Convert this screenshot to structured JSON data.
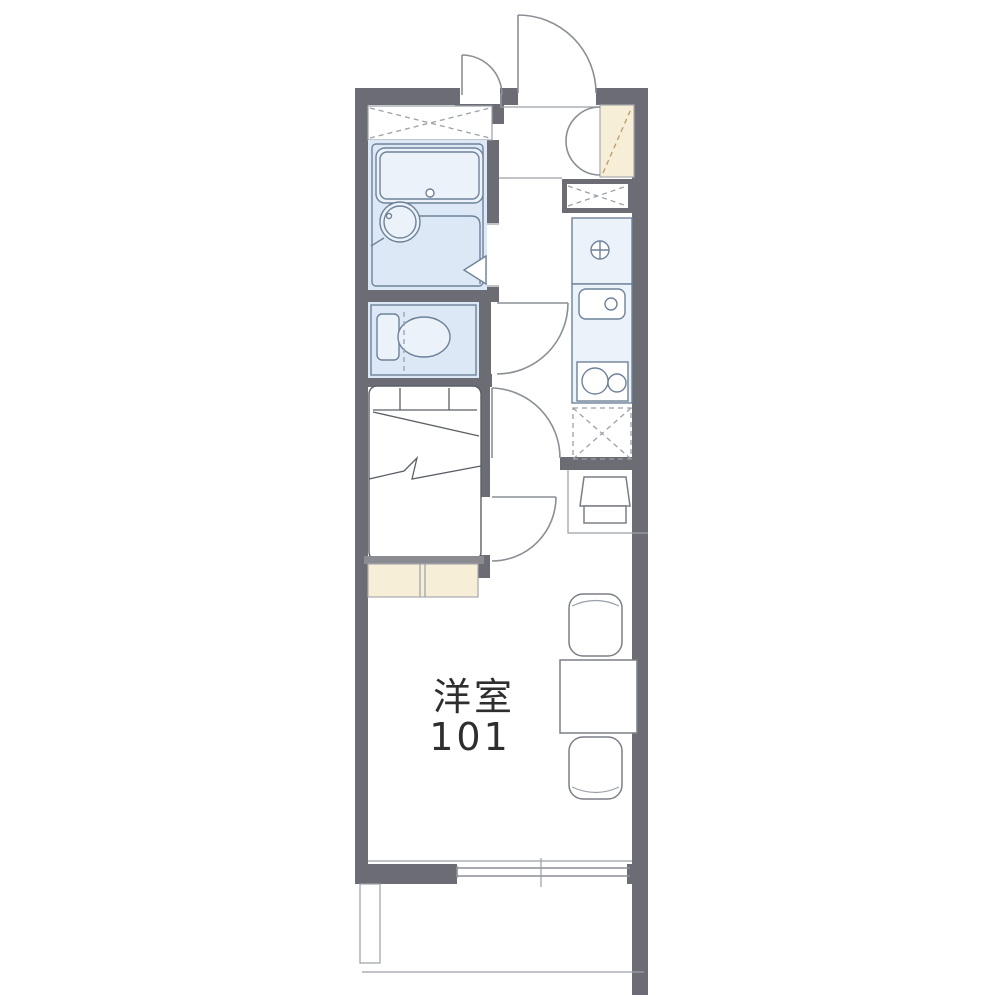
{
  "floorplan": {
    "room_label": {
      "line1": "洋室",
      "line2": "101"
    },
    "colors": {
      "background": "#ffffff",
      "wall": "#6c6c75",
      "water_area_fill": "#dce8f6",
      "water_area_stroke": "#6e8299",
      "storage_fill": "#f6eed6",
      "storage_dash": "#b79d6a",
      "line": "#9aa0a8",
      "furniture_stroke": "#7a7f85",
      "label_text": "#2e2e30"
    },
    "fixtures": [
      "entrance-door",
      "small-door",
      "shoe-cabinet",
      "shoe-cabinet-doors",
      "overhead-closet",
      "bathtub",
      "washbasin",
      "bathroom-folding-door",
      "toilet",
      "hall-door",
      "washing-machine-space",
      "washing-machine-pan",
      "kitchen-sink",
      "gas-stove",
      "refrigerator-space",
      "room-door",
      "bedroom-door",
      "bed",
      "under-bed-storage",
      "tv-stand",
      "table",
      "chair-top",
      "chair-bottom",
      "sliding-window",
      "balcony"
    ]
  }
}
